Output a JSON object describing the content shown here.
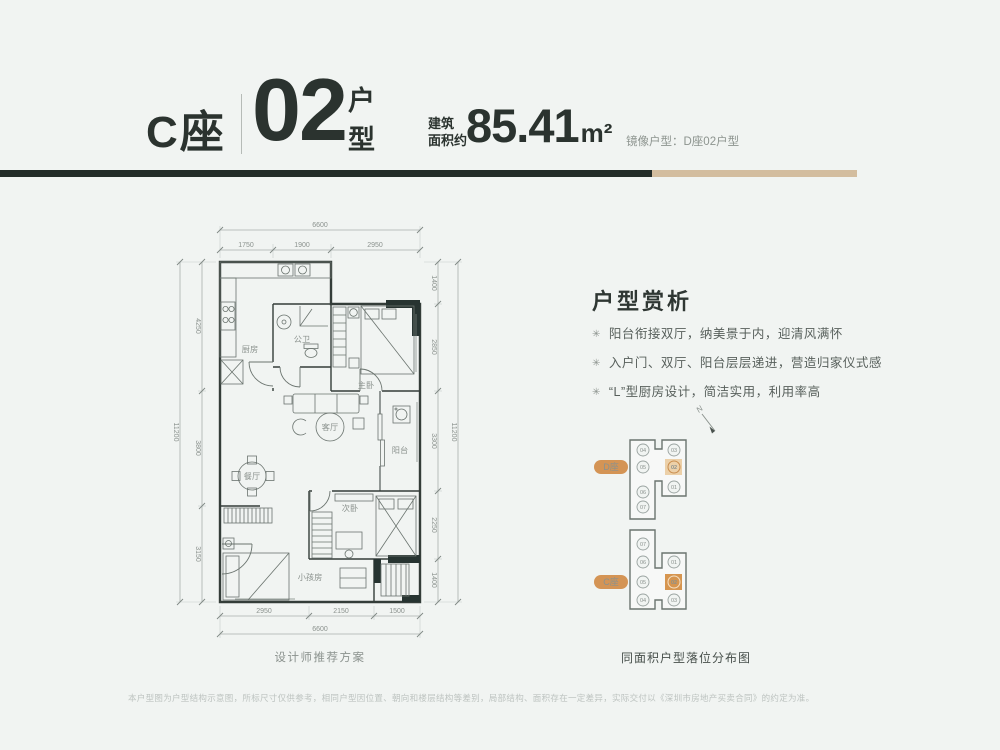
{
  "header": {
    "block_label": "C座",
    "unit_number": "02",
    "unit_suffix": [
      "户",
      "型"
    ],
    "area_prefix": [
      "建筑",
      "面积约"
    ],
    "area_value": "85.41",
    "area_unit": "m²",
    "mirror_note": "镜像户型：D座02户型"
  },
  "floorplan": {
    "caption": "设计师推荐方案",
    "rooms": {
      "kitchen": "厨房",
      "bath": "公卫",
      "master": "主卧",
      "living": "客厅",
      "dining": "餐厅",
      "balcony": "阳台",
      "second": "次卧",
      "kids": "小孩房"
    },
    "dims": {
      "top_total": "6600",
      "top": [
        "1750",
        "1900",
        "2950"
      ],
      "bottom": [
        "2950",
        "2150",
        "1500"
      ],
      "bottom_total": "6600",
      "left_total": "11200",
      "left": [
        "4250",
        "3800",
        "3150"
      ],
      "right": [
        "1400",
        "2850",
        "3300",
        "2250",
        "1400"
      ],
      "right_total": "11200"
    }
  },
  "analysis": {
    "title": "户型赏析",
    "bullet_icon": "✳",
    "bullets": [
      "阳台衔接双厅，纳美景于内，迎清风满怀",
      "入户门、双厅、阳台层层递进，营造归家仪式感",
      "“L”型厨房设计，简洁实用，利用率高"
    ]
  },
  "location_map": {
    "north": "N",
    "caption": "同面积户型落位分布图",
    "blocks": [
      {
        "label": "D座",
        "left_units": [
          "04",
          "05",
          "06",
          "07"
        ],
        "right_units": [
          "03",
          "02",
          "01"
        ],
        "highlight": "02"
      },
      {
        "label": "C座",
        "left_units": [
          "07",
          "06",
          "05",
          "04"
        ],
        "right_units": [
          "01",
          "02",
          "03"
        ],
        "highlight": "02"
      }
    ]
  },
  "footer": {
    "disclaimer": "本户型图为户型结构示意图，所标尺寸仅供参考，相同户型因位置、朝向和楼层结构等差别，局部结构、面积存在一定差异，实际交付以《深圳市房地产买卖合同》的约定为准。"
  },
  "colors": {
    "accent_dark": "#242d29",
    "accent_tan": "#d3bd9f",
    "highlight_orange": "#d6954f",
    "highlight_tan": "#ecd0a8",
    "wall": "#343d39"
  }
}
